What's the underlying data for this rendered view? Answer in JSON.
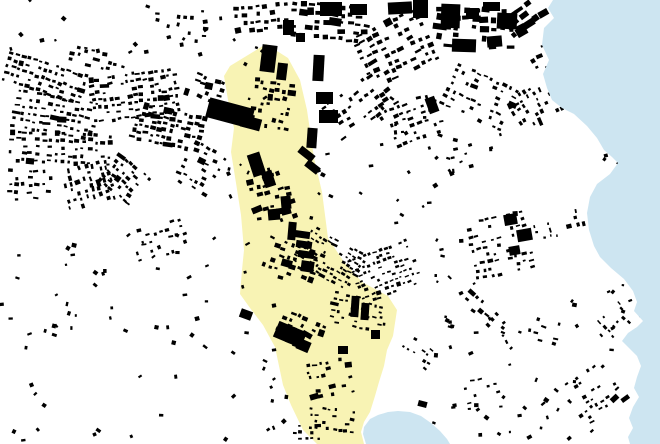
{
  "map": {
    "description": "Figure-ground map of a coastal city: black building footprints on white land, pale yellow highlighted valley corridor running north-south to a small bay, light blue sea along the east edge",
    "canvas": {
      "width": 660,
      "height": 444
    },
    "colors": {
      "land": "#ffffff",
      "building": "#000000",
      "highlight": "#f8f3b4",
      "water": "#cde5f1"
    },
    "seed": 1337,
    "highlight_zone": {
      "name": "valley-corridor",
      "points": [
        [
          266,
          44
        ],
        [
          288,
          58
        ],
        [
          300,
          80
        ],
        [
          307,
          110
        ],
        [
          314,
          158
        ],
        [
          322,
          192
        ],
        [
          328,
          238
        ],
        [
          344,
          262
        ],
        [
          362,
          282
        ],
        [
          388,
          296
        ],
        [
          397,
          310
        ],
        [
          393,
          336
        ],
        [
          387,
          350
        ],
        [
          384,
          366
        ],
        [
          379,
          382
        ],
        [
          375,
          396
        ],
        [
          370,
          412
        ],
        [
          364,
          422
        ],
        [
          361,
          432
        ],
        [
          364,
          444
        ],
        [
          317,
          444
        ],
        [
          303,
          430
        ],
        [
          291,
          405
        ],
        [
          283,
          385
        ],
        [
          275,
          347
        ],
        [
          263,
          325
        ],
        [
          250,
          308
        ],
        [
          240,
          294
        ],
        [
          242,
          270
        ],
        [
          244,
          250
        ],
        [
          241,
          215
        ],
        [
          236,
          183
        ],
        [
          231,
          152
        ],
        [
          234,
          128
        ],
        [
          228,
          100
        ],
        [
          224,
          76
        ],
        [
          230,
          66
        ]
      ]
    },
    "water_bodies": [
      {
        "name": "sea-east",
        "points": [
          [
            553,
            0
          ],
          [
            548,
            8
          ],
          [
            554,
            18
          ],
          [
            544,
            28
          ],
          [
            542,
            45
          ],
          [
            549,
            60
          ],
          [
            543,
            74
          ],
          [
            547,
            88
          ],
          [
            552,
            100
          ],
          [
            562,
            108
          ],
          [
            574,
            114
          ],
          [
            587,
            126
          ],
          [
            597,
            138
          ],
          [
            604,
            150
          ],
          [
            612,
            157
          ],
          [
            618,
            163
          ],
          [
            610,
            174
          ],
          [
            597,
            184
          ],
          [
            590,
            197
          ],
          [
            587,
            213
          ],
          [
            589,
            230
          ],
          [
            594,
            246
          ],
          [
            600,
            257
          ],
          [
            611,
            268
          ],
          [
            624,
            279
          ],
          [
            633,
            291
          ],
          [
            637,
            302
          ],
          [
            634,
            311
          ],
          [
            643,
            321
          ],
          [
            637,
            327
          ],
          [
            628,
            333
          ],
          [
            622,
            341
          ],
          [
            630,
            349
          ],
          [
            637,
            356
          ],
          [
            641,
            366
          ],
          [
            637,
            377
          ],
          [
            634,
            388
          ],
          [
            639,
            397
          ],
          [
            633,
            407
          ],
          [
            629,
            418
          ],
          [
            633,
            428
          ],
          [
            628,
            437
          ],
          [
            630,
            444
          ],
          [
            660,
            444
          ],
          [
            660,
            0
          ]
        ]
      },
      {
        "name": "bay-south",
        "points": [
          [
            366,
            444
          ],
          [
            363,
            434
          ],
          [
            364,
            427
          ],
          [
            370,
            419
          ],
          [
            378,
            415
          ],
          [
            388,
            412
          ],
          [
            398,
            411
          ],
          [
            410,
            412
          ],
          [
            421,
            416
          ],
          [
            431,
            423
          ],
          [
            440,
            431
          ],
          [
            447,
            439
          ],
          [
            450,
            444
          ]
        ]
      }
    ],
    "cluster_fields": [
      "cx",
      "cy",
      "cols",
      "rows",
      "dx",
      "dy",
      "bw",
      "bh",
      "angle",
      "density"
    ],
    "clusters": [
      [
        45,
        78,
        14,
        5,
        6,
        7,
        3.5,
        2.5,
        18,
        0.75
      ],
      [
        135,
        95,
        15,
        7,
        6,
        7,
        3.5,
        2.5,
        -8,
        0.72
      ],
      [
        55,
        115,
        13,
        6,
        6.5,
        7,
        3.5,
        2.5,
        10,
        0.78
      ],
      [
        168,
        128,
        12,
        6,
        6,
        6.5,
        4,
        3,
        12,
        0.75
      ],
      [
        60,
        148,
        16,
        5,
        6.5,
        7,
        3.5,
        2.5,
        3,
        0.72
      ],
      [
        88,
        185,
        7,
        8,
        6,
        6.5,
        3.5,
        2.5,
        75,
        0.65
      ],
      [
        125,
        180,
        7,
        6,
        6,
        6.5,
        3.5,
        2.5,
        40,
        0.65
      ],
      [
        30,
        185,
        7,
        5,
        6.5,
        7,
        3.5,
        2.5,
        0,
        0.55
      ],
      [
        160,
        240,
        8,
        5,
        7,
        7.5,
        3.5,
        2.5,
        -15,
        0.5
      ],
      [
        205,
        88,
        6,
        4,
        6.5,
        7,
        4,
        3,
        20,
        0.7
      ],
      [
        200,
        168,
        6,
        7,
        6.5,
        7,
        3.5,
        2.5,
        30,
        0.55
      ],
      [
        262,
        18,
        8,
        4,
        7,
        7.5,
        4,
        3,
        -5,
        0.65
      ],
      [
        330,
        22,
        10,
        5,
        8,
        8,
        5,
        3.5,
        5,
        0.7
      ],
      [
        395,
        48,
        10,
        8,
        7.5,
        7.5,
        4.5,
        3,
        -25,
        0.65
      ],
      [
        360,
        105,
        10,
        6,
        7,
        7.5,
        4,
        2.8,
        -35,
        0.55
      ],
      [
        415,
        120,
        8,
        6,
        7,
        7.5,
        3.8,
        2.6,
        -20,
        0.5
      ],
      [
        475,
        28,
        9,
        5,
        9,
        9,
        6,
        4.5,
        3,
        0.68
      ],
      [
        524,
        16,
        5,
        3,
        9,
        9,
        6,
        4.5,
        -35,
        0.65
      ],
      [
        480,
        97,
        10,
        7,
        7,
        7,
        3.6,
        2.4,
        25,
        0.5
      ],
      [
        538,
        103,
        6,
        9,
        6.5,
        6.5,
        3.4,
        2.4,
        62,
        0.55
      ],
      [
        500,
        245,
        9,
        9,
        7,
        7,
        3.4,
        2.3,
        -12,
        0.5
      ],
      [
        573,
        222,
        4,
        12,
        6.5,
        7,
        3.2,
        2.2,
        80,
        0.45
      ],
      [
        272,
        105,
        6,
        7,
        7,
        7.5,
        4,
        3,
        10,
        0.55
      ],
      [
        272,
        195,
        6,
        8,
        7,
        7.5,
        4,
        3,
        -15,
        0.55
      ],
      [
        290,
        262,
        8,
        6,
        7,
        7,
        4,
        3,
        20,
        0.55
      ],
      [
        330,
        258,
        12,
        8,
        5.5,
        5.5,
        3,
        2,
        30,
        0.68
      ],
      [
        385,
        272,
        12,
        9,
        5.5,
        5.5,
        3,
        2,
        -20,
        0.6
      ],
      [
        360,
        312,
        10,
        6,
        6,
        6,
        3.2,
        2.2,
        10,
        0.55
      ],
      [
        300,
        332,
        7,
        5,
        6.5,
        7,
        4,
        3,
        25,
        0.55
      ],
      [
        330,
        378,
        7,
        6,
        6.5,
        6.5,
        3.4,
        2.4,
        -10,
        0.5
      ],
      [
        332,
        420,
        8,
        4,
        6,
        6.5,
        3,
        2.2,
        5,
        0.55
      ],
      [
        306,
        432,
        5,
        3,
        6,
        6,
        3,
        2.2,
        0,
        0.55
      ],
      [
        487,
        315,
        9,
        3,
        6.5,
        6.5,
        3.4,
        2.4,
        40,
        0.55
      ],
      [
        595,
        397,
        8,
        9,
        6.5,
        6.5,
        3.4,
        2.4,
        -35,
        0.5
      ],
      [
        540,
        330,
        6,
        4,
        7,
        7,
        3.4,
        2.4,
        15,
        0.4
      ],
      [
        475,
        395,
        7,
        5,
        7.5,
        7.5,
        3.2,
        2.2,
        -10,
        0.32
      ],
      [
        455,
        165,
        5,
        3,
        7,
        7,
        3.4,
        2.4,
        -20,
        0.45
      ],
      [
        616,
        320,
        4,
        5,
        6.5,
        6.5,
        3.2,
        2.2,
        45,
        0.45
      ],
      [
        180,
        28,
        8,
        4,
        7,
        7.5,
        3.6,
        2.6,
        10,
        0.35
      ],
      [
        545,
        57,
        4,
        4,
        7.5,
        7.5,
        4.5,
        3.2,
        -30,
        0.55
      ],
      [
        418,
        352,
        6,
        4,
        6.5,
        6.5,
        3,
        2.2,
        35,
        0.45
      ],
      [
        100,
        60,
        10,
        3,
        6.5,
        7,
        3.5,
        2.5,
        15,
        0.55
      ]
    ],
    "scatter_fields": [
      "x",
      "y",
      "w",
      "h",
      "count",
      "smin",
      "smax"
    ],
    "scatter": [
      [
        0,
        230,
        230,
        90,
        30,
        2,
        5
      ],
      [
        0,
        320,
        230,
        124,
        26,
        2,
        5
      ],
      [
        232,
        300,
        55,
        130,
        14,
        2,
        5
      ],
      [
        360,
        150,
        80,
        85,
        10,
        2,
        5
      ],
      [
        430,
        330,
        90,
        110,
        20,
        2,
        5
      ],
      [
        520,
        355,
        55,
        85,
        12,
        2,
        5
      ],
      [
        430,
        230,
        45,
        60,
        8,
        2,
        5
      ],
      [
        0,
        0,
        240,
        55,
        22,
        2,
        5
      ],
      [
        228,
        148,
        22,
        150,
        8,
        2,
        5
      ],
      [
        598,
        138,
        45,
        38,
        6,
        2,
        4
      ],
      [
        440,
        130,
        70,
        45,
        10,
        2,
        5
      ],
      [
        372,
        96,
        60,
        52,
        12,
        2,
        5
      ],
      [
        618,
        268,
        30,
        48,
        6,
        2,
        4
      ],
      [
        440,
        288,
        70,
        40,
        8,
        2,
        5
      ],
      [
        556,
        290,
        60,
        60,
        8,
        2,
        5
      ],
      [
        310,
        150,
        26,
        80,
        6,
        2,
        5
      ],
      [
        244,
        44,
        24,
        60,
        8,
        2,
        5
      ]
    ],
    "landmark_fields": [
      "x",
      "y",
      "w",
      "h",
      "angle"
    ],
    "landmarks": [
      [
        207,
        103,
        46,
        20,
        15
      ],
      [
        241,
        117,
        20,
        12,
        15
      ],
      [
        261,
        45,
        15,
        27,
        7
      ],
      [
        277,
        63,
        10,
        17,
        7
      ],
      [
        313,
        55,
        11,
        26,
        3
      ],
      [
        316,
        92,
        17,
        12,
        0
      ],
      [
        319,
        110,
        19,
        13,
        0
      ],
      [
        307,
        128,
        10,
        20,
        4
      ],
      [
        298,
        150,
        17,
        8,
        38
      ],
      [
        305,
        163,
        15,
        8,
        38
      ],
      [
        250,
        153,
        13,
        23,
        -18
      ],
      [
        263,
        171,
        11,
        16,
        -18
      ],
      [
        281,
        196,
        10,
        13,
        -5
      ],
      [
        268,
        209,
        12,
        11,
        -5
      ],
      [
        288,
        222,
        8,
        18,
        5
      ],
      [
        294,
        231,
        16,
        7,
        8
      ],
      [
        296,
        241,
        16,
        7,
        8
      ],
      [
        298,
        251,
        16,
        7,
        8
      ],
      [
        301,
        261,
        13,
        11,
        8
      ],
      [
        275,
        326,
        30,
        17,
        23
      ],
      [
        297,
        340,
        13,
        11,
        23
      ],
      [
        240,
        310,
        12,
        9,
        20
      ],
      [
        351,
        296,
        8,
        21,
        4
      ],
      [
        361,
        303,
        8,
        17,
        4
      ],
      [
        283,
        20,
        11,
        15,
        0
      ],
      [
        296,
        33,
        9,
        9,
        0
      ],
      [
        320,
        2,
        22,
        14,
        0
      ],
      [
        350,
        4,
        17,
        11,
        0
      ],
      [
        388,
        2,
        24,
        12,
        -3
      ],
      [
        413,
        0,
        15,
        18,
        0
      ],
      [
        441,
        4,
        19,
        24,
        2
      ],
      [
        466,
        8,
        13,
        11,
        0
      ],
      [
        483,
        2,
        17,
        9,
        0
      ],
      [
        497,
        13,
        20,
        16,
        3
      ],
      [
        452,
        39,
        24,
        13,
        2
      ],
      [
        487,
        36,
        15,
        11,
        -5
      ],
      [
        516,
        27,
        11,
        9,
        -30
      ],
      [
        504,
        214,
        13,
        11,
        -10
      ],
      [
        517,
        229,
        15,
        12,
        -10
      ],
      [
        509,
        246,
        11,
        9,
        -10
      ],
      [
        427,
        97,
        10,
        16,
        -20
      ],
      [
        371,
        330,
        9,
        9,
        0
      ],
      [
        338,
        346,
        10,
        8,
        0
      ]
    ],
    "piers": [
      [
        418,
        401,
        9,
        6,
        15
      ]
    ]
  }
}
